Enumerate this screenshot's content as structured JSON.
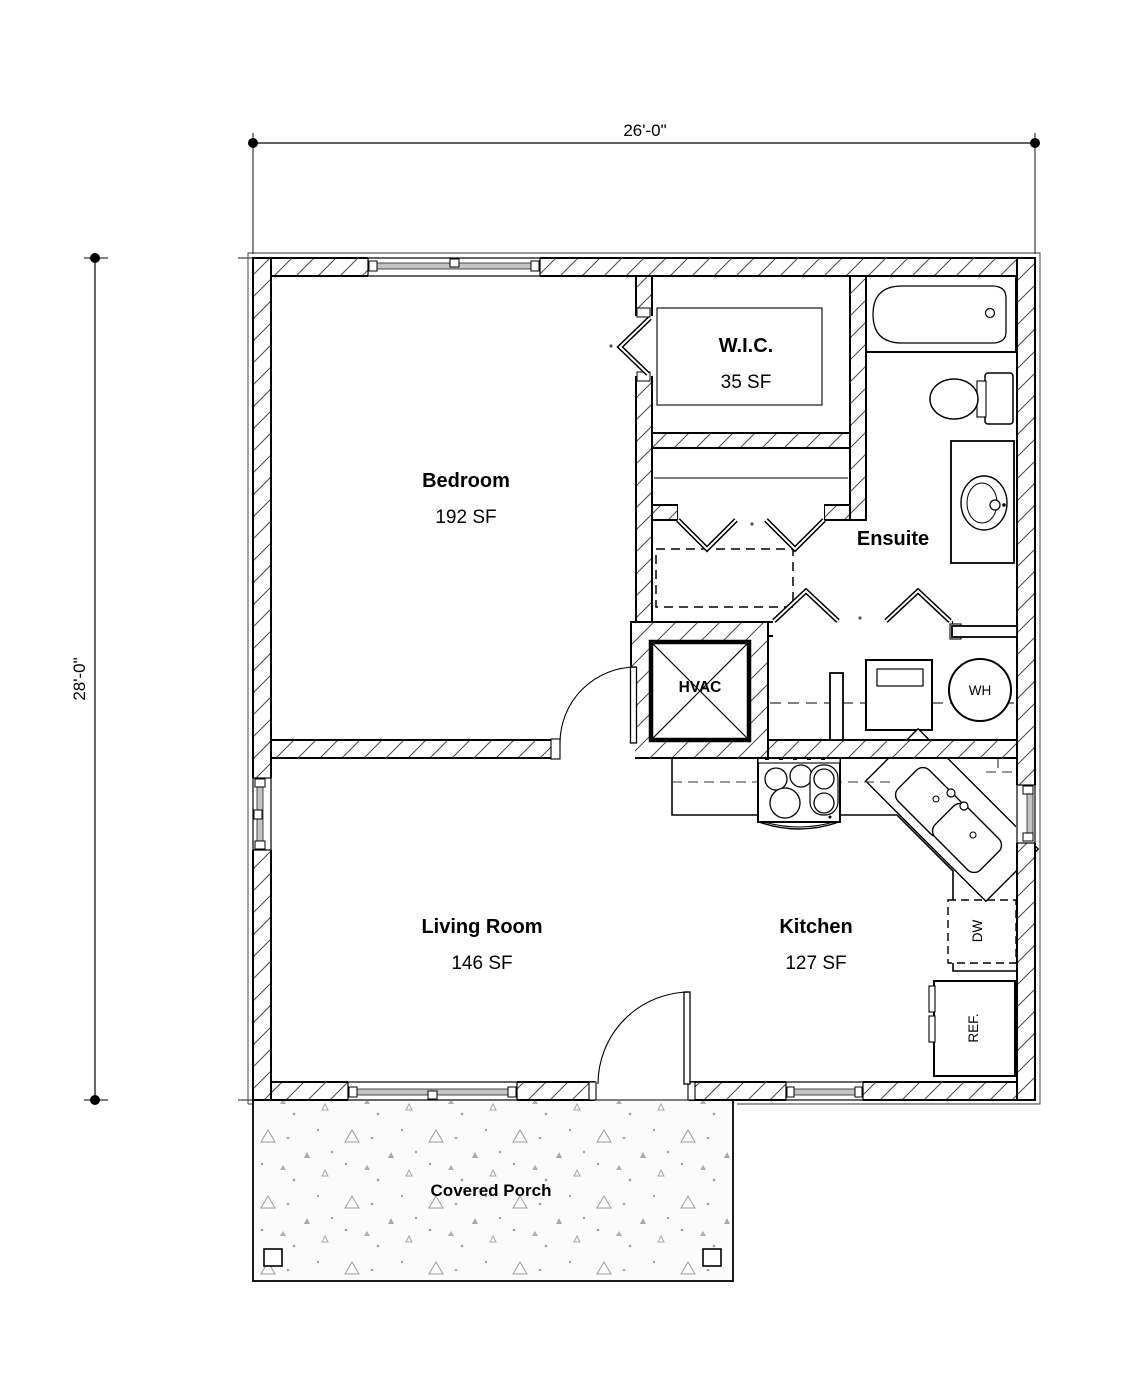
{
  "plan": {
    "dimensions": {
      "width": "26'-0\"",
      "height": "28'-0\""
    },
    "rooms": {
      "bedroom": {
        "name": "Bedroom",
        "area": "192 SF"
      },
      "wic": {
        "name": "W.I.C.",
        "area": "35 SF"
      },
      "ensuite": {
        "name": "Ensuite"
      },
      "living_room": {
        "name": "Living Room",
        "area": "146 SF"
      },
      "kitchen": {
        "name": "Kitchen",
        "area": "127 SF"
      },
      "covered_porch": {
        "name": "Covered Porch"
      }
    },
    "fixtures": {
      "hvac": "HVAC",
      "water_heater": "WH",
      "dishwasher": "DW",
      "refrigerator": "REF."
    }
  },
  "colors": {
    "line": "#000000",
    "wall_hatch": "#4a4a4a",
    "window_glass": "#c4c4c4",
    "porch_speckle": "#9e9e9e",
    "paper": "#ffffff"
  }
}
